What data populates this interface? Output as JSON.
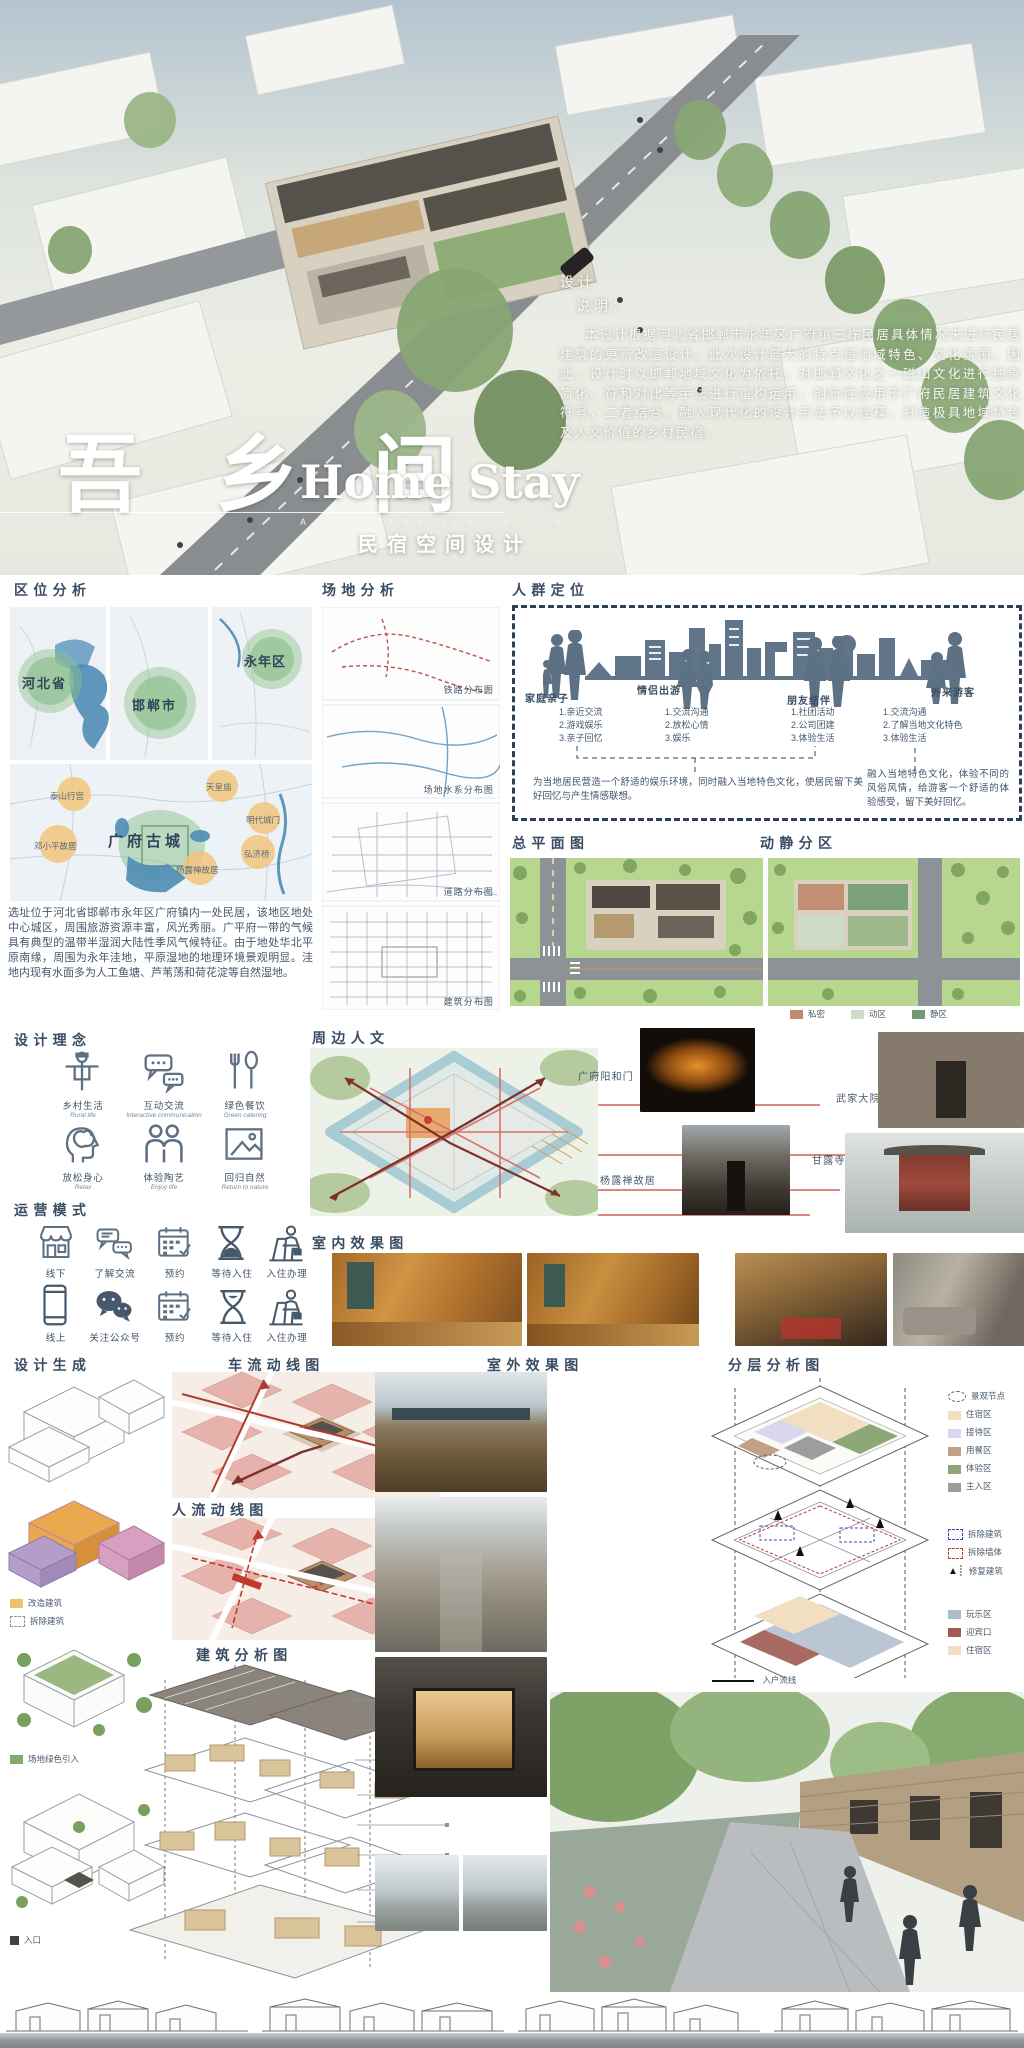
{
  "hero": {
    "title_cn": "吾 乡 间",
    "title_en": "Home Stay",
    "subtitle_en": "Accommodation in the",
    "subtitle_cn": "民宿空间设计",
    "note_line1": "设计",
    "note_line2": "说明：",
    "description": "本设计根据河北省邯郸市永年区广府镇三栋民居具体情况来进行民居建筑的更新改造设计。此次设计最大的特点是地域特色、文化氛围，因此，设计时以邯郸地域文化为依托，对邯郸文化之一磁山文化进行抽象简化、符和对比等手法进行重构运用，创新性应用于广府民居建筑文化符号，二者结合，融入现代化的设计手法予以诠释，打造极具地域特色及人文价值的乡村民宿。"
  },
  "location": {
    "heading": "区位分析",
    "map_labels": [
      "河北省",
      "邯郸市",
      "永年区"
    ],
    "poi_center": "广府古城",
    "poi": [
      "泰山行宫",
      "天皇庙",
      "明代城门",
      "弘济桥",
      "杨露禅故居",
      "邓小平故居"
    ],
    "paragraph": "选址位于河北省邯郸市永年区广府镇内一处民居，该地区地处中心城区，周围旅游资源丰富，风光秀丽。广平府一带的气候具有典型的温带半湿润大陆性季风气候特征。由于地处华北平原南缘，周围为永年洼地，平原湿地的地理环境景观明显。洼地内现有水面多为人工鱼塘、芦苇荡和荷花淀等自然湿地。"
  },
  "site": {
    "heading": "场地分析",
    "map_labels": [
      "铁路分布图",
      "场地水系分布图",
      "道路分布图",
      "建筑分布图"
    ]
  },
  "audience": {
    "heading": "人群定位",
    "groups": [
      {
        "name": "家庭亲子",
        "items": [
          "1.亲近交流",
          "2.游戏娱乐",
          "3.亲子回忆"
        ]
      },
      {
        "name": "情侣出游",
        "items": [
          "1.交流沟通",
          "2.放松心情",
          "3.娱乐"
        ]
      },
      {
        "name": "朋友结伴",
        "items": [
          "1.社团活动",
          "2.公司团建",
          "3.体验生活"
        ]
      },
      {
        "name": "外来游客",
        "items": [
          "1.交流沟通",
          "2.了解当地文化特色",
          "3.体验生活"
        ]
      }
    ],
    "summary_left": "为当地居民营造一个舒适的娱乐环境，同时融入当地特色文化，使居民留下美好回忆与产生情感联想。",
    "summary_right": "融入当地特色文化，体验不同的风俗风情，给游客一个舒适的体验感受，留下美好回忆。"
  },
  "masterplan": {
    "heading": "总平面图"
  },
  "zoning": {
    "heading": "动静分区",
    "legend": [
      {
        "label": "私密",
        "color": "#c28b70"
      },
      {
        "label": "动区",
        "color": "#ccdcc8"
      },
      {
        "label": "静区",
        "color": "#6f9b72"
      }
    ]
  },
  "concept": {
    "heading": "设计理念",
    "items": [
      {
        "cn": "乡村生活",
        "en": "Rural life"
      },
      {
        "cn": "互动交流",
        "en": "Interactive communication"
      },
      {
        "cn": "绿色餐饮",
        "en": "Green catering"
      },
      {
        "cn": "放松身心",
        "en": "Relax"
      },
      {
        "cn": "体验陶艺",
        "en": "Enjoy life"
      },
      {
        "cn": "回归自然",
        "en": "Return to nature"
      }
    ]
  },
  "operation": {
    "heading": "运营模式",
    "row1": [
      "线下",
      "了解交流",
      "预约",
      "等待入住",
      "入住办理"
    ],
    "row2": [
      "线上",
      "关注公众号",
      "预约",
      "等待入住",
      "入住办理"
    ]
  },
  "culture": {
    "heading": "周边人文",
    "captions": [
      "广府阳和门",
      "武家大院",
      "杨露禅故居",
      "甘露寺"
    ]
  },
  "interior": {
    "heading": "室内效果图"
  },
  "generation": {
    "heading": "设计生成",
    "legend": [
      {
        "label": "改造建筑",
        "color": "#ecc36a"
      },
      {
        "label": "拆除建筑"
      }
    ],
    "legend_green": "场地绿色引入",
    "entry_label": "入口"
  },
  "flows": {
    "vehicle_heading": "车流动线图",
    "people_heading": "人流动线图"
  },
  "building": {
    "heading": "建筑分析图"
  },
  "exterior": {
    "heading": "室外效果图"
  },
  "layers": {
    "heading": "分层分析图",
    "zone_legend": [
      {
        "label": "景观节点"
      },
      {
        "label": "住宿区",
        "color": "#f2dfc2"
      },
      {
        "label": "接待区",
        "color": "#d9d7ee"
      },
      {
        "label": "用餐区",
        "color": "#c2a084"
      },
      {
        "label": "体验区",
        "color": "#8ca878"
      },
      {
        "label": "主入区",
        "color": "#9d9d9d"
      }
    ],
    "mark_legend": [
      {
        "label": "拆除建筑"
      },
      {
        "label": "拆除墙体"
      },
      {
        "label": "修复建筑"
      }
    ],
    "bottom_legend": [
      {
        "label": "玩乐区",
        "color": "#aebccd"
      },
      {
        "label": "迎宾口",
        "color": "#a05a50"
      },
      {
        "label": "住宿区",
        "color": "#f2dfc2"
      }
    ],
    "flow_label": "入户流线"
  }
}
